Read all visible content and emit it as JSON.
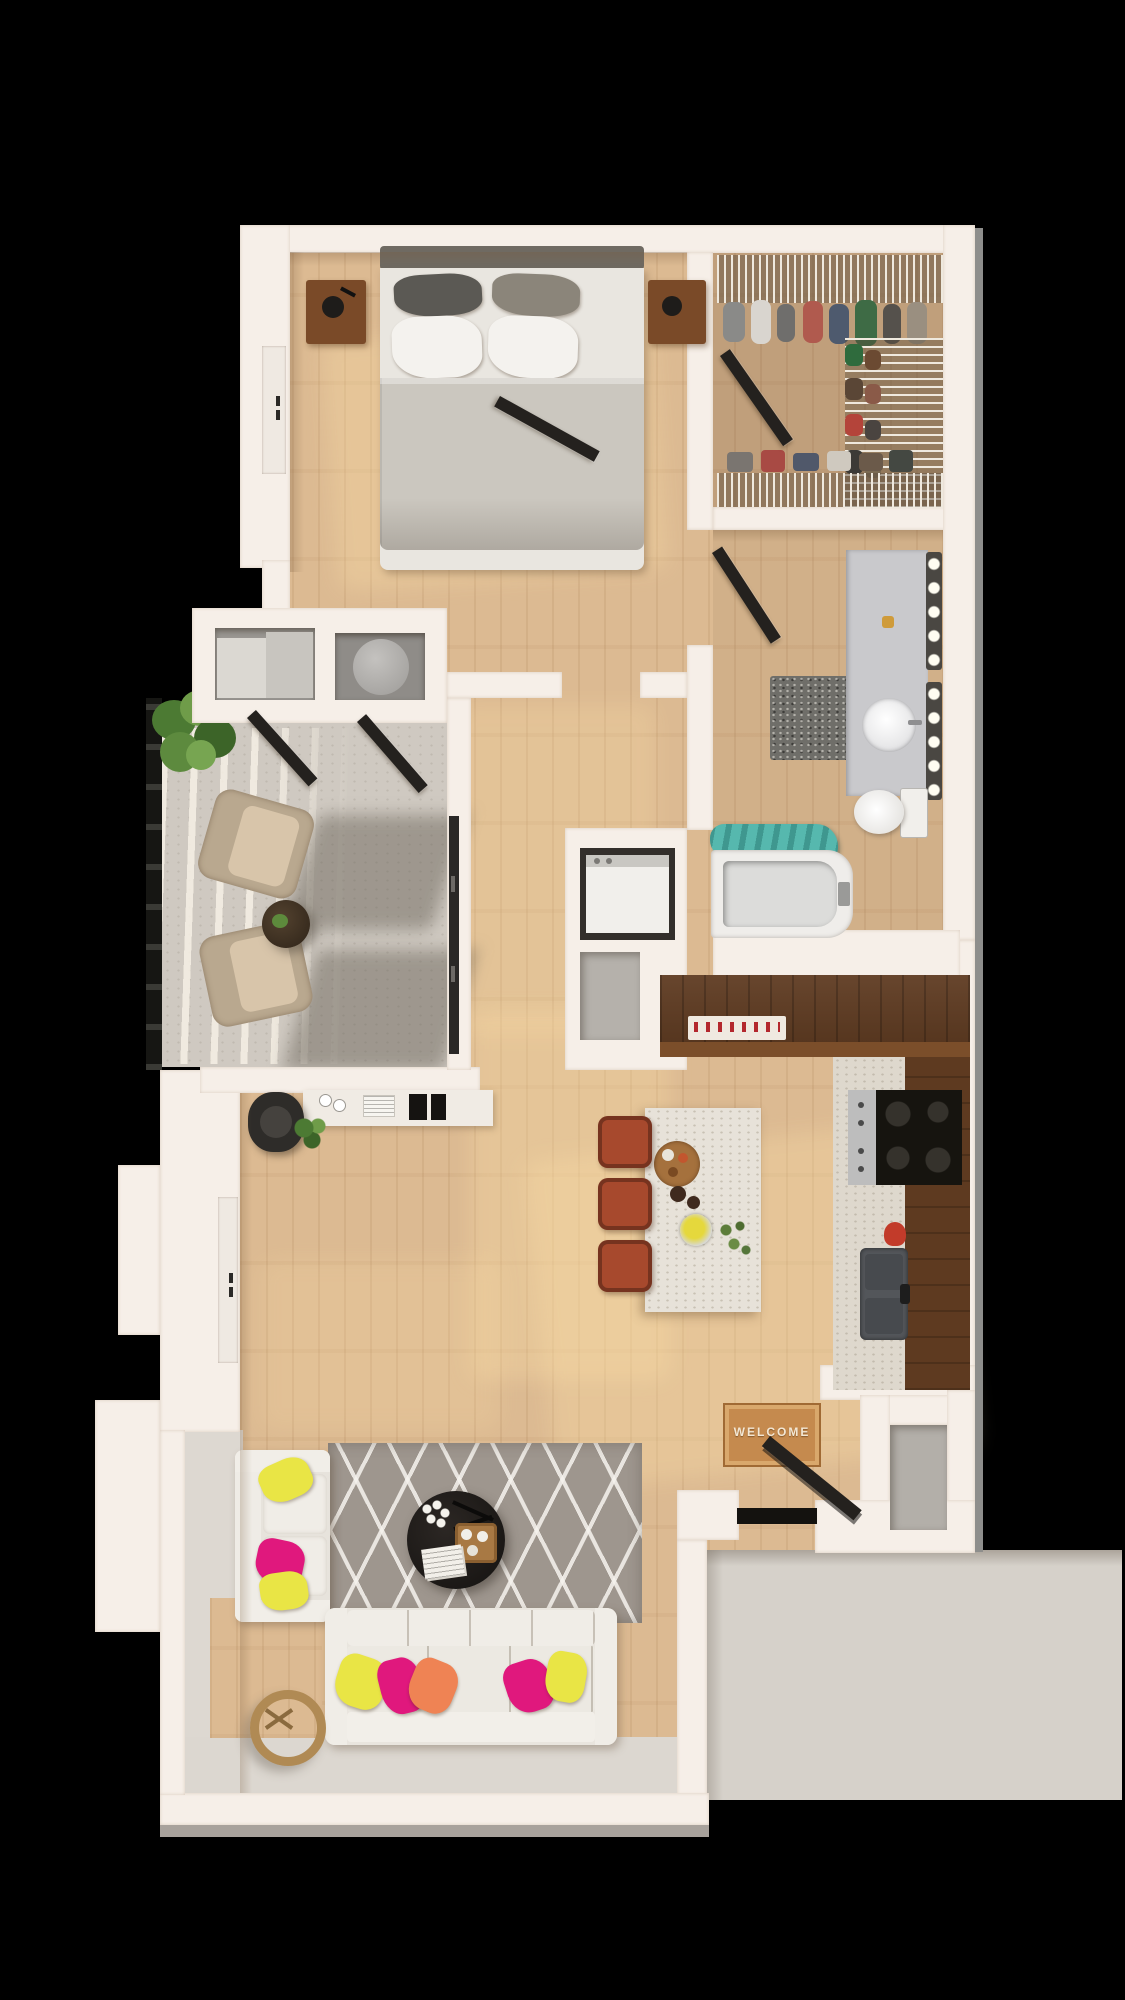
{
  "scene": {
    "description": "3D top-down rendered floor plan of a one-bedroom apartment with balcony",
    "background_color": "#000000",
    "doormat_text": "WELCOME"
  },
  "palette": {
    "wall": "#f6efe8",
    "wood_floor": "#dcba92",
    "dark_wood_cabinets": "#5e3a20",
    "balcony_concrete": "#cfc9c1",
    "exterior_slab": "#d6d1ca",
    "living_rug": "#9e968e",
    "bath_rug": "#6f6e69",
    "sofa": "#efece6",
    "bed_duvet": "#cbc7bf",
    "pillow_yellow": "#e9e545",
    "pillow_magenta": "#e0187d",
    "pillow_orange": "#ef8354",
    "stool_rust": "#a7492d",
    "towel_teal": "#56b8ae",
    "island_marble": "#e7e2d9",
    "door_dark": "#24211e",
    "plant_green": "#57833a"
  },
  "rooms": [
    {
      "id": "bedroom",
      "label": "bedroom"
    },
    {
      "id": "walk-in-closet",
      "label": "walk-in closet"
    },
    {
      "id": "bathroom",
      "label": "bathroom"
    },
    {
      "id": "hallway",
      "label": "hallway"
    },
    {
      "id": "balcony",
      "label": "balcony"
    },
    {
      "id": "living-room",
      "label": "living room"
    },
    {
      "id": "kitchen",
      "label": "kitchen"
    },
    {
      "id": "entry",
      "label": "entry"
    },
    {
      "id": "exterior-landing",
      "label": "exterior landing"
    }
  ],
  "furniture": {
    "bedroom": [
      "double bed",
      "two nightstands with lamps",
      "leaning mirror",
      "window"
    ],
    "walk_in_closet": [
      "wire shelving with clothes",
      "shoe rack",
      "open door"
    ],
    "bathroom": [
      "vanity with sink",
      "vanity light strips",
      "toilet",
      "bathtub",
      "teal towel",
      "speckled rug"
    ],
    "hallway": [
      "sliding-door closet",
      "water-heater closet",
      "laundry closet with washer",
      "pantry closet"
    ],
    "balcony": [
      "potted plant",
      "two lounge chairs",
      "round side table",
      "railing"
    ],
    "living_room": [
      "desk with office chair",
      "sectional sofa",
      "throw pillows",
      "round coffee table",
      "ring side table",
      "diamond-pattern rug"
    ],
    "kitchen": [
      "L-shaped walnut counter",
      "range with cooktop",
      "double-basin sink",
      "marble island with food tray",
      "three bar stools",
      "knife rack"
    ],
    "entry": [
      "welcome doormat",
      "open front door",
      "coat closet"
    ]
  }
}
